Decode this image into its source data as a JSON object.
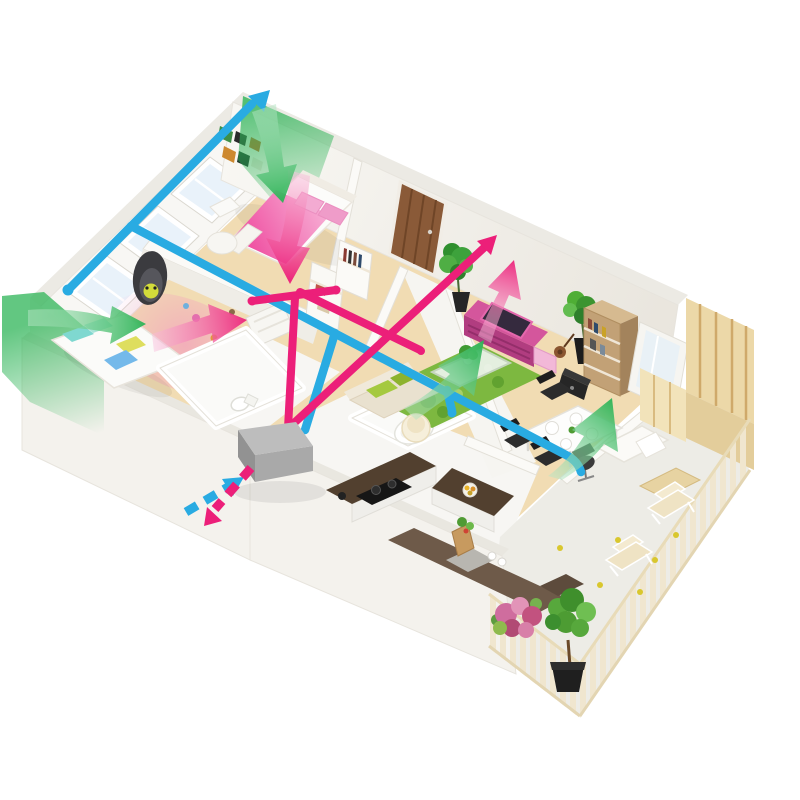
{
  "meta": {
    "description": "Isometric 3D cutaway floor plan of an apartment showing a ducted heat-recovery ventilation system with supply and extract air flows",
    "background": "#ffffff",
    "width": 800,
    "height": 800
  },
  "colors": {
    "supply_duct": "#29abe2",
    "extract_duct": "#ec1f79",
    "fresh_air": "#2eb457",
    "fresh_air_light": "#b7e6c6",
    "extract_light": "#f9c2de",
    "outdoor_air_wash": "#2eb457",
    "hrv_unit_top": "#bdbdbd",
    "hrv_unit_side": "#929292",
    "hrv_unit_front": "#a9a9a9",
    "wall": "#fbfaf7",
    "wood_floor": "#f1dcb3",
    "tile_floor": "#f7f6f3",
    "balcony_floor": "#edece6",
    "grass_rug": "#7db840",
    "bed_duvet_pink": "#ee3f98",
    "bed_duvet_pink_light": "#f8bcdc",
    "tv_unit_pink": "#d4569c",
    "entry_door_wood": "#8a5a38",
    "plywood": "#ecd8a8",
    "fence_slat": "#f0e6cf"
  },
  "scene": {
    "rooms": [
      {
        "id": "master-bedroom",
        "furniture": [
          "double-bed",
          "pink-duvet",
          "pillows",
          "side-chair",
          "draped-table",
          "gallery-pictures",
          "hall-wardrobes"
        ]
      },
      {
        "id": "kids-bedroom",
        "furniture": [
          "single-bed",
          "teal-pillows",
          "hanging-egg-chair",
          "toys"
        ]
      },
      {
        "id": "bathroom",
        "furniture": [
          "toilet"
        ]
      },
      {
        "id": "shower-room",
        "furniture": [
          "round-tub"
        ]
      },
      {
        "id": "kitchen",
        "furniture": [
          "l-shaped-counter",
          "cooktop",
          "island",
          "fruit-bowl",
          "grocery-bag",
          "walkway-tiles",
          "doormat"
        ]
      },
      {
        "id": "entry-hall",
        "furniture": [
          "entry-door"
        ]
      },
      {
        "id": "living-room",
        "furniture": [
          "grass-rug",
          "coffee-table",
          "bonsai",
          "sofa",
          "floor-lamp",
          "tv-sideboard",
          "tv",
          "violin",
          "potted-plants",
          "bookshelf",
          "speaker-box",
          "sliding-window",
          "dining-table",
          "dining-chairs",
          "desk",
          "office-chair"
        ]
      },
      {
        "id": "balcony",
        "furniture": [
          "slatted-fence",
          "deck-chairs",
          "flower-bush",
          "potted-tree",
          "storage-shed",
          "wood-board",
          "fallen-leaves"
        ]
      }
    ],
    "ventilation": {
      "unit": "heat-recovery-ventilation-unit",
      "supply_elements": [
        "exterior-wall-supply-duct",
        "supply-branch-duct",
        "supply-drop-to-unit",
        "supply-outlet-stub",
        "outdoor-intake-arrow"
      ],
      "extract_elements": [
        "extract-riser",
        "extract-tee",
        "extract-diagonal-duct",
        "extract-branch-duct",
        "exhaust-outlet-arrow"
      ],
      "fresh_air_arrows": [
        "master-bedroom",
        "kids-bedroom",
        "living-room",
        "dining-area"
      ],
      "extract_air_arrows": [
        "master-bedroom",
        "kids-bedroom",
        "living-room"
      ],
      "outdoor_air_washes": [
        "top-corner",
        "left-corner"
      ]
    }
  }
}
